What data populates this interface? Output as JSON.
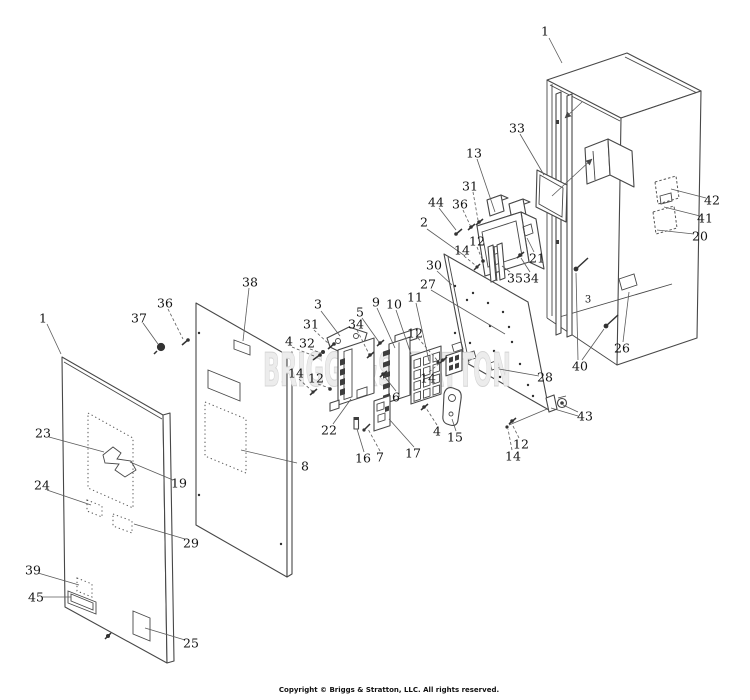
{
  "colors": {
    "background": "#ffffff",
    "line": "#474747",
    "label": "#141414",
    "watermark": "#dedede"
  },
  "watermark": {
    "text": "BRIGGS&STRATTON"
  },
  "footer": {
    "copyright": "Copyright © Briggs & Stratton, LLC. All rights reserved."
  },
  "callouts": [
    {
      "label": "1",
      "x": 545,
      "y": 31
    },
    {
      "label": "1",
      "x": 43,
      "y": 318
    },
    {
      "label": "2",
      "x": 424,
      "y": 222
    },
    {
      "label": "3",
      "x": 318,
      "y": 304
    },
    {
      "label": "3",
      "x": 588,
      "y": 298,
      "small": true
    },
    {
      "label": "4",
      "x": 289,
      "y": 341
    },
    {
      "label": "4",
      "x": 437,
      "y": 431
    },
    {
      "label": "5",
      "x": 360,
      "y": 312
    },
    {
      "label": "6",
      "x": 396,
      "y": 397
    },
    {
      "label": "7",
      "x": 380,
      "y": 457
    },
    {
      "label": "8",
      "x": 305,
      "y": 466
    },
    {
      "label": "9",
      "x": 376,
      "y": 302
    },
    {
      "label": "10",
      "x": 394,
      "y": 304
    },
    {
      "label": "11",
      "x": 415,
      "y": 297
    },
    {
      "label": "12",
      "x": 316,
      "y": 378
    },
    {
      "label": "12",
      "x": 415,
      "y": 333
    },
    {
      "label": "12",
      "x": 477,
      "y": 241
    },
    {
      "label": "12",
      "x": 521,
      "y": 444
    },
    {
      "label": "13",
      "x": 474,
      "y": 153
    },
    {
      "label": "14",
      "x": 296,
      "y": 373
    },
    {
      "label": "14",
      "x": 428,
      "y": 378
    },
    {
      "label": "14",
      "x": 462,
      "y": 250
    },
    {
      "label": "14",
      "x": 513,
      "y": 456
    },
    {
      "label": "15",
      "x": 455,
      "y": 437
    },
    {
      "label": "16",
      "x": 363,
      "y": 458
    },
    {
      "label": "17",
      "x": 413,
      "y": 453
    },
    {
      "label": "19",
      "x": 179,
      "y": 483
    },
    {
      "label": "20",
      "x": 700,
      "y": 236
    },
    {
      "label": "21",
      "x": 537,
      "y": 258
    },
    {
      "label": "22",
      "x": 329,
      "y": 430
    },
    {
      "label": "23",
      "x": 43,
      "y": 433
    },
    {
      "label": "24",
      "x": 42,
      "y": 485
    },
    {
      "label": "25",
      "x": 191,
      "y": 643
    },
    {
      "label": "26",
      "x": 622,
      "y": 348
    },
    {
      "label": "27",
      "x": 428,
      "y": 284
    },
    {
      "label": "28",
      "x": 545,
      "y": 377
    },
    {
      "label": "29",
      "x": 191,
      "y": 543
    },
    {
      "label": "30",
      "x": 434,
      "y": 265
    },
    {
      "label": "31",
      "x": 470,
      "y": 186
    },
    {
      "label": "31",
      "x": 311,
      "y": 324
    },
    {
      "label": "32",
      "x": 307,
      "y": 343
    },
    {
      "label": "33",
      "x": 517,
      "y": 128
    },
    {
      "label": "34",
      "x": 356,
      "y": 324
    },
    {
      "label": "34",
      "x": 531,
      "y": 278
    },
    {
      "label": "35",
      "x": 515,
      "y": 278
    },
    {
      "label": "36",
      "x": 460,
      "y": 204
    },
    {
      "label": "36",
      "x": 165,
      "y": 303
    },
    {
      "label": "37",
      "x": 139,
      "y": 318
    },
    {
      "label": "38",
      "x": 250,
      "y": 282
    },
    {
      "label": "39",
      "x": 33,
      "y": 570
    },
    {
      "label": "40",
      "x": 580,
      "y": 366
    },
    {
      "label": "41",
      "x": 705,
      "y": 218
    },
    {
      "label": "42",
      "x": 712,
      "y": 200
    },
    {
      "label": "43",
      "x": 585,
      "y": 416
    },
    {
      "label": "44",
      "x": 436,
      "y": 202
    },
    {
      "label": "45",
      "x": 36,
      "y": 597
    }
  ]
}
